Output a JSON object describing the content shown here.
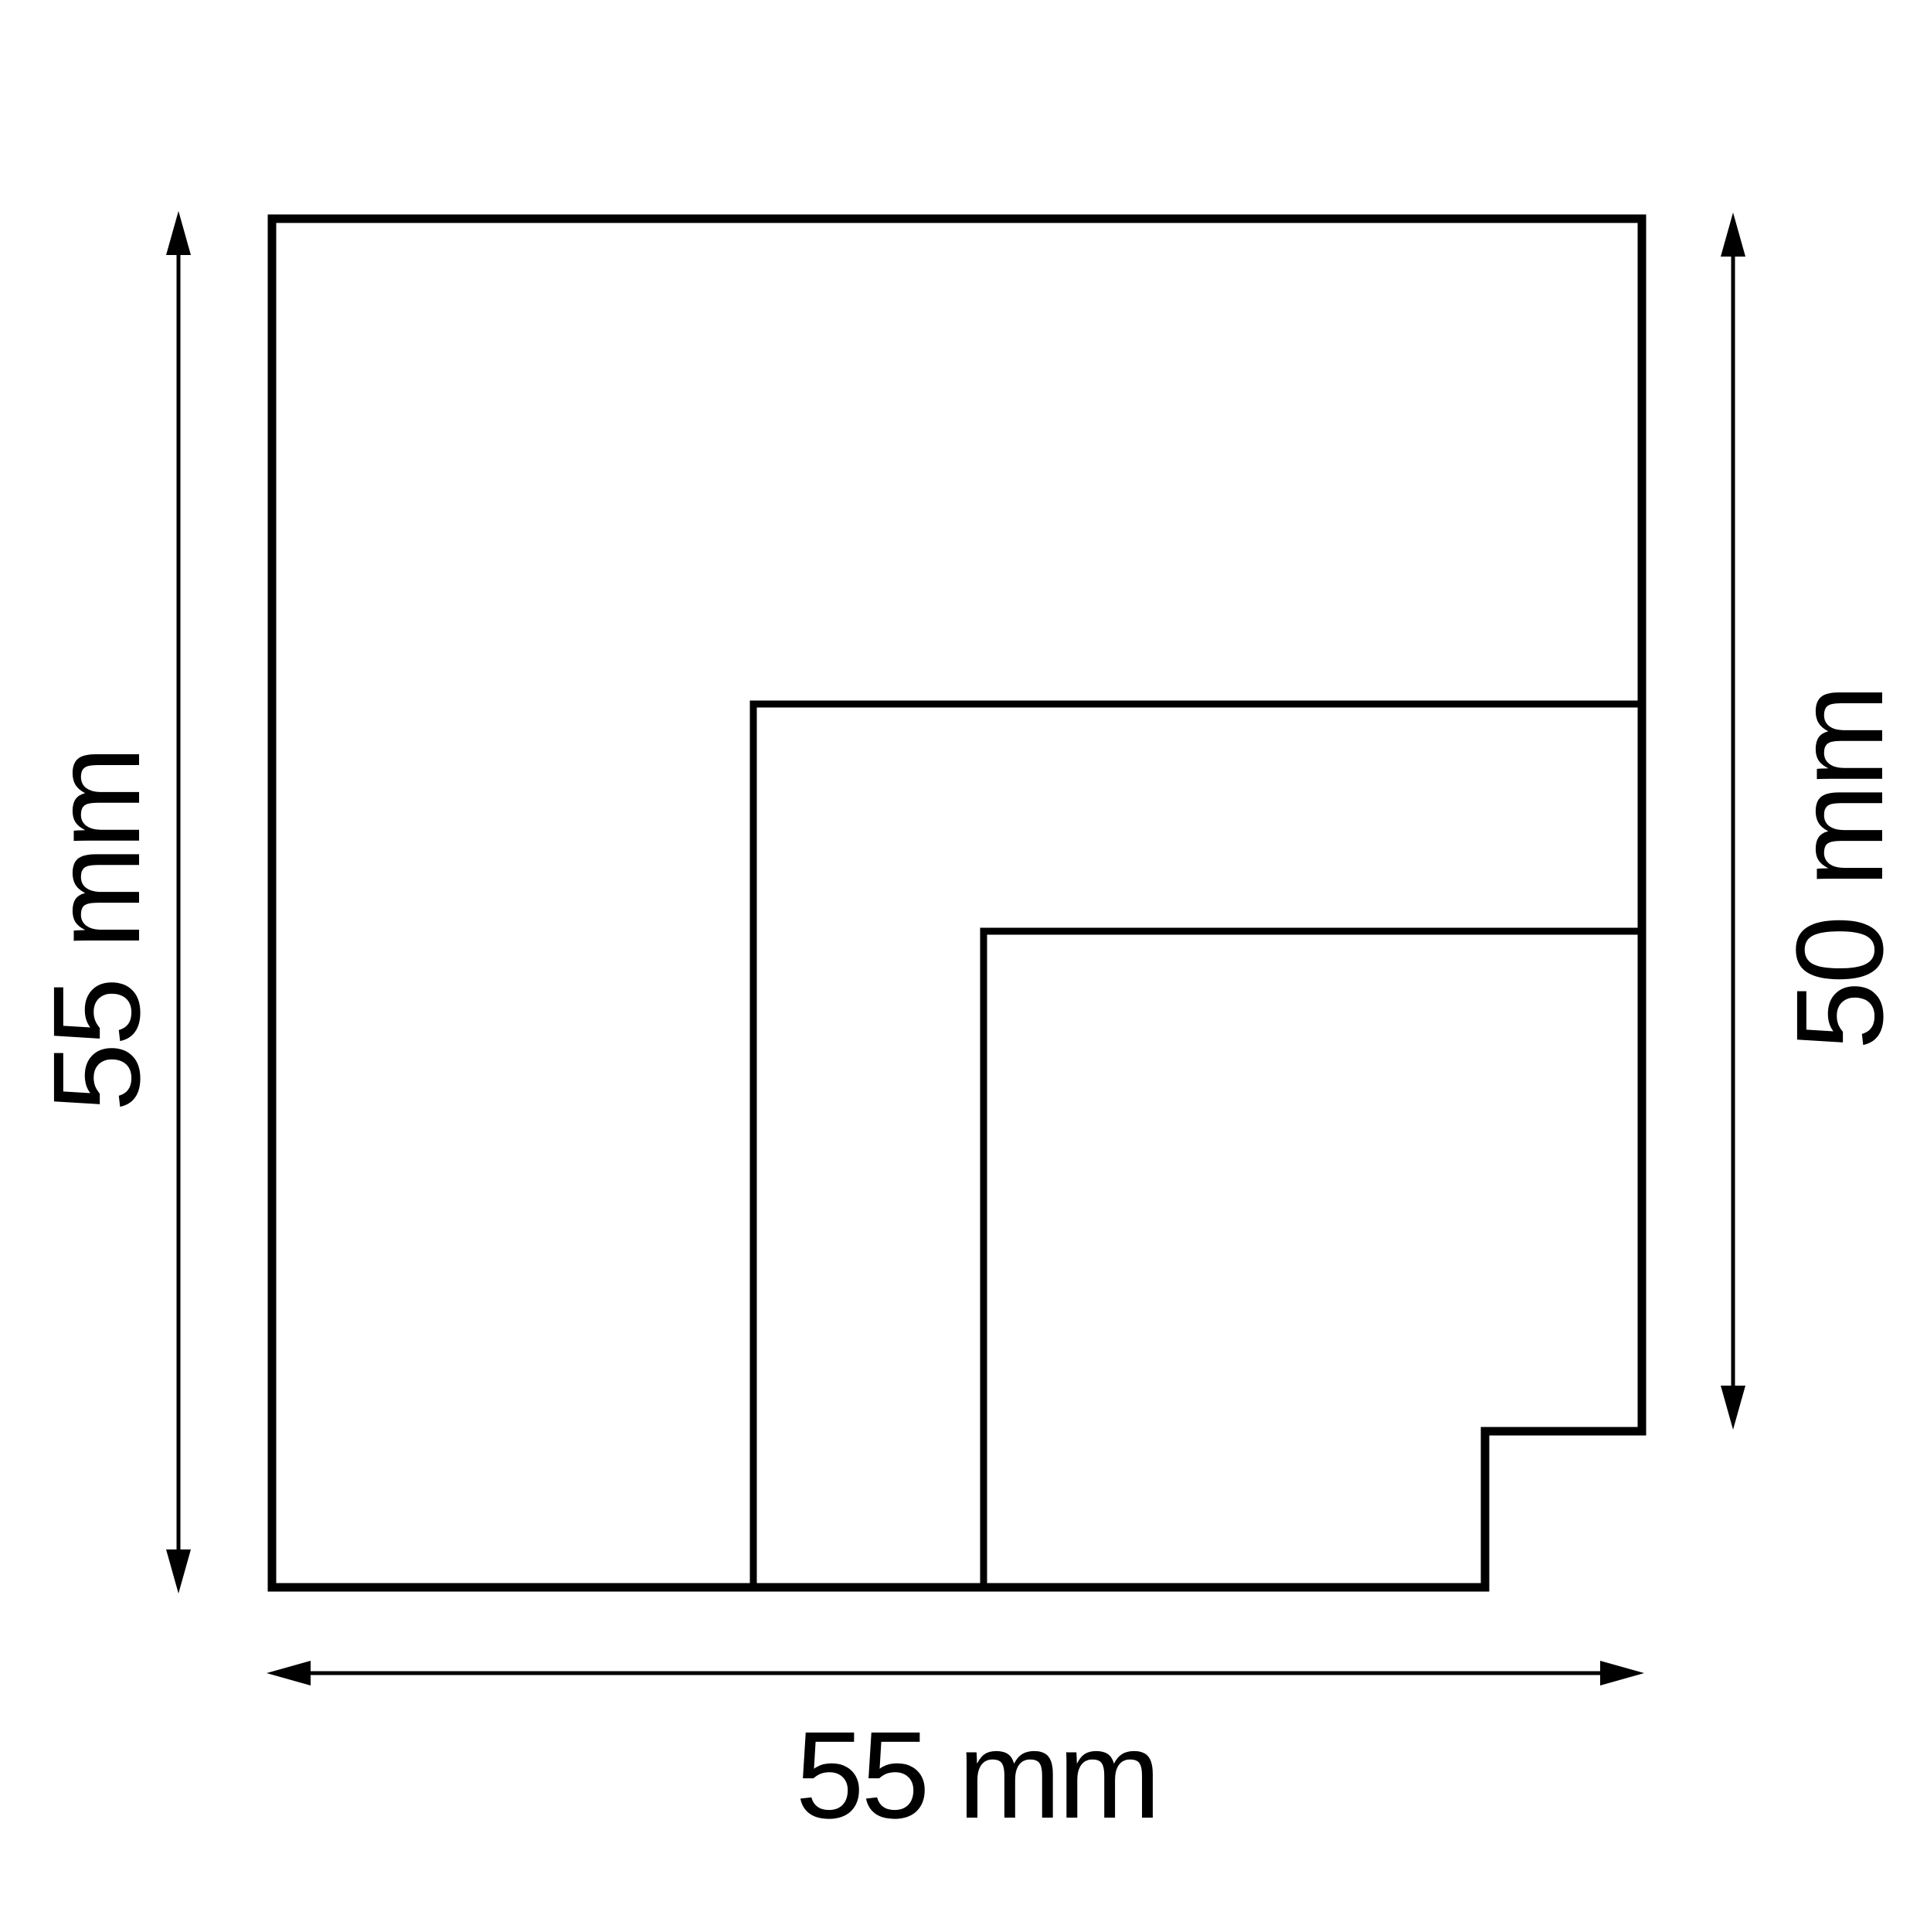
{
  "figure": {
    "background": "#ffffff",
    "stroke_color": "#000000",
    "dimensions": {
      "left": "55 mm",
      "right": "50 mm",
      "bottom": "55 mm"
    }
  }
}
